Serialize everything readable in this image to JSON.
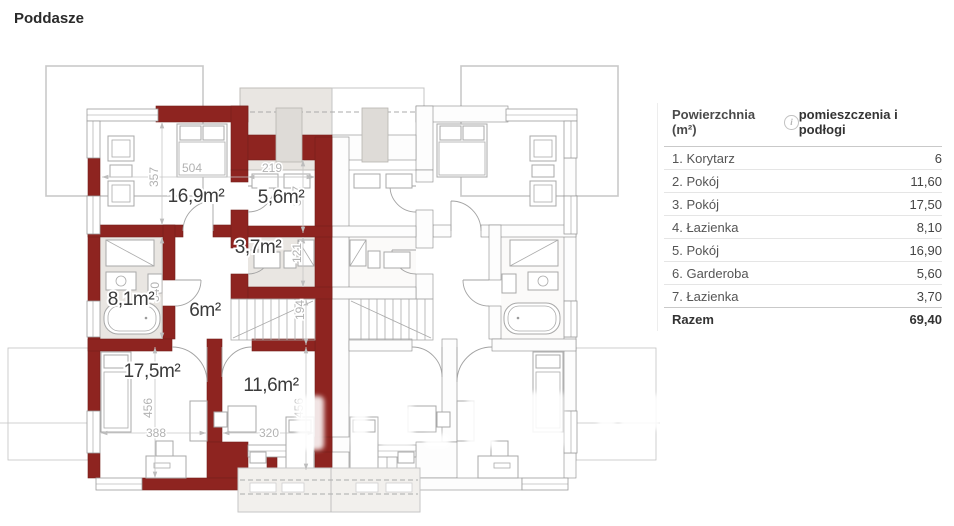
{
  "page": {
    "title": "Poddasze"
  },
  "table": {
    "header": {
      "area_label": "Powierzchnia (m²)",
      "info_icon": "i",
      "rooms_label": "pomieszczenia i podłogi"
    },
    "rows": [
      {
        "name": "1. Korytarz",
        "value": "6"
      },
      {
        "name": "2. Pokój",
        "value": "11,60"
      },
      {
        "name": "3. Pokój",
        "value": "17,50"
      },
      {
        "name": "4. Łazienka",
        "value": "8,10"
      },
      {
        "name": "5. Pokój",
        "value": "16,90"
      },
      {
        "name": "6. Garderoba",
        "value": "5,60"
      },
      {
        "name": "7. Łazienka",
        "value": "3,70"
      }
    ],
    "total": {
      "name": "Razem",
      "value": "69,40"
    }
  },
  "floorplan": {
    "floor_name": "Poddasze",
    "selected_unit": "left",
    "room_labels": {
      "pokoj_a": "16,9m²",
      "garderoba": "5,6m²",
      "lazienka_mala": "3,7m²",
      "lazienka_duza": "8,1m²",
      "korytarz": "6m²",
      "pokoj_b": "17,5m²",
      "pokoj_c": "11,6m²"
    },
    "dimensions": {
      "d504": "504",
      "d357_left": "357",
      "d219": "219",
      "d357_right": "357",
      "d121": "121",
      "d340": "340",
      "d194": "194",
      "d456_left": "456",
      "d388": "388",
      "d456_right": "456",
      "d320": "320"
    },
    "colors": {
      "selected_wall": "#8E2420",
      "room_fill": "#E9E6E2",
      "unselected_wall": "#8A8A8A",
      "dim_text": "#B2B2B2"
    }
  }
}
